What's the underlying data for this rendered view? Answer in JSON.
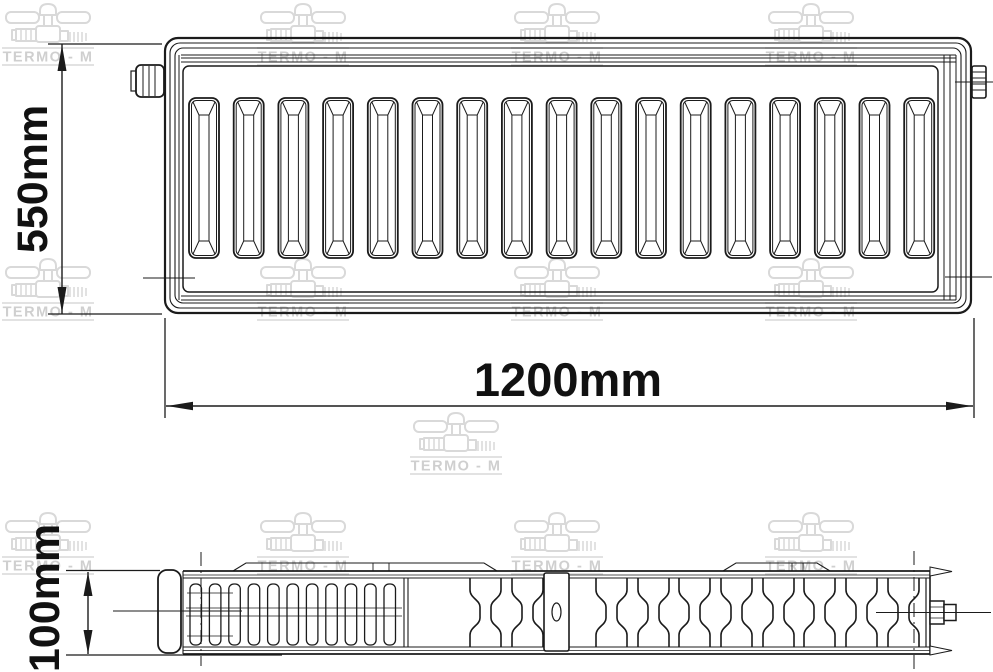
{
  "dimensions": {
    "height": "550mm",
    "width": "1200mm",
    "depth": "100mm"
  },
  "watermark": {
    "brand_text": "TERMO - M",
    "color": "#d9d9d9",
    "text_color": "#cfcfcf",
    "count": 13
  },
  "drawing": {
    "line_color": "#1b1b1b",
    "background": "#ffffff",
    "views": {
      "front": {
        "channel_count": 17
      },
      "plan": {
        "fin_count": 11,
        "slot_count": 10,
        "bracket_count": 1
      }
    }
  }
}
